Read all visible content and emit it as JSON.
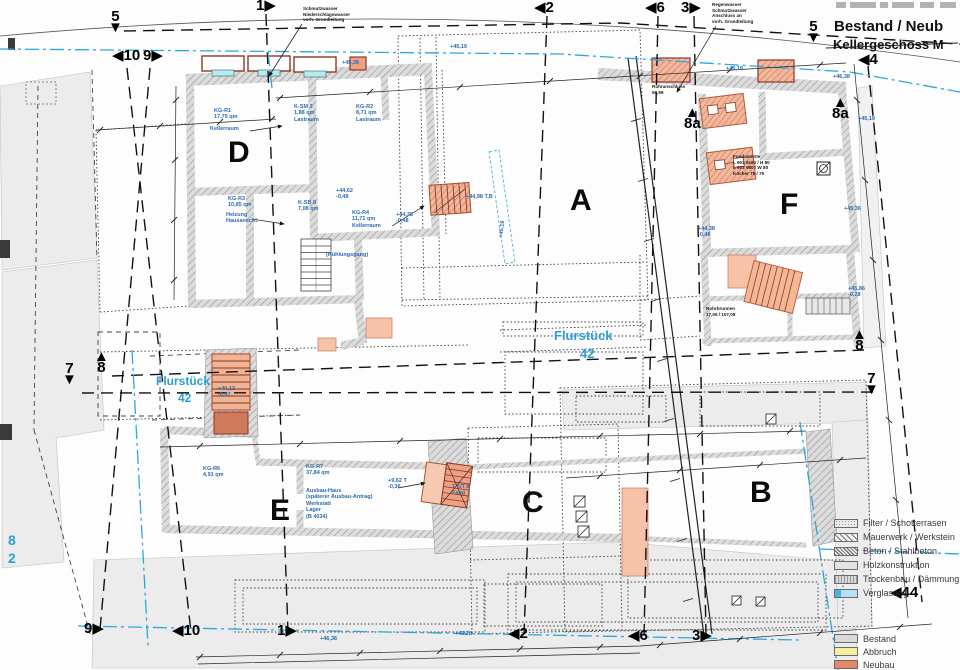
{
  "title": {
    "line1": "Bestand / Neub",
    "line2": "Kellergeschoss M"
  },
  "buildings": [
    {
      "label": "D"
    },
    {
      "label": "A"
    },
    {
      "label": "F"
    },
    {
      "label": "E"
    },
    {
      "label": "C"
    },
    {
      "label": "B"
    }
  ],
  "grid_markers": [
    {
      "n": "5",
      "t": "d",
      "x": 108,
      "y": 12
    },
    {
      "n": "1",
      "t": "r",
      "x": 256,
      "y": 1
    },
    {
      "n": "2",
      "t": "l",
      "x": 534,
      "y": 3
    },
    {
      "n": "6",
      "t": "l",
      "x": 645,
      "y": 3
    },
    {
      "n": "3",
      "t": "r",
      "x": 681,
      "y": 3
    },
    {
      "n": "5",
      "t": "d",
      "x": 806,
      "y": 22
    },
    {
      "n": "10",
      "t": "l",
      "x": 112,
      "y": 51
    },
    {
      "n": "9",
      "t": "r",
      "x": 143,
      "y": 51
    },
    {
      "n": "7",
      "t": "d",
      "x": 62,
      "y": 364
    },
    {
      "n": "8",
      "t": "u",
      "x": 94,
      "y": 352
    },
    {
      "n": "4",
      "t": "l",
      "x": 858,
      "y": 55
    },
    {
      "n": "8a",
      "t": "u",
      "x": 832,
      "y": 98
    },
    {
      "n": "8a",
      "t": "u",
      "x": 684,
      "y": 108
    },
    {
      "n": "8",
      "t": "u",
      "x": 852,
      "y": 330
    },
    {
      "n": "7",
      "t": "d",
      "x": 864,
      "y": 374
    },
    {
      "n": "9",
      "t": "r",
      "x": 84,
      "y": 624
    },
    {
      "n": "10",
      "t": "l",
      "x": 172,
      "y": 626
    },
    {
      "n": "1",
      "t": "r",
      "x": 277,
      "y": 626
    },
    {
      "n": "2",
      "t": "l",
      "x": 508,
      "y": 629
    },
    {
      "n": "6",
      "t": "l",
      "x": 628,
      "y": 631
    },
    {
      "n": "3",
      "t": "r",
      "x": 692,
      "y": 631
    },
    {
      "n": "44",
      "t": "l",
      "x": 890,
      "y": 588
    }
  ],
  "blue_labels": [
    {
      "t": "KG-R1\n17,75 qm",
      "x": 214,
      "y": 108
    },
    {
      "t": "Kellerraum",
      "x": 210,
      "y": 126
    },
    {
      "t": "K-SM 3\n1,88 qm\nLastraum",
      "x": 294,
      "y": 104
    },
    {
      "t": "KG-R2\n8,71 qm\nLastraum",
      "x": 356,
      "y": 104
    },
    {
      "t": "KG-R3\n10,85 qm",
      "x": 228,
      "y": 196
    },
    {
      "t": "Heizung\nHausanschl.",
      "x": 226,
      "y": 212
    },
    {
      "t": "K-SB 8\n7,08 qm",
      "x": 298,
      "y": 200
    },
    {
      "t": "+44,62\n-0,48",
      "x": 336,
      "y": 188
    },
    {
      "t": "KG-R4\n11,71 qm\nKellerraum",
      "x": 352,
      "y": 210
    },
    {
      "t": "(Kühlungsgang)",
      "x": 326,
      "y": 252
    },
    {
      "t": "+44,98 T,B",
      "x": 466,
      "y": 194
    },
    {
      "t": "+44,38\n-0,48",
      "x": 396,
      "y": 212
    },
    {
      "t": "+45,38",
      "x": 342,
      "y": 60
    },
    {
      "t": "+45,19",
      "x": 450,
      "y": 44
    },
    {
      "t": "+45,19",
      "x": 494,
      "y": 226,
      "rot": -83
    },
    {
      "t": "Flurstück",
      "x": 554,
      "y": 328,
      "fs": 13
    },
    {
      "t": "42",
      "x": 580,
      "y": 346,
      "fs": 13
    },
    {
      "t": "Flurstück",
      "x": 156,
      "y": 374,
      "fs": 12
    },
    {
      "t": "42",
      "x": 178,
      "y": 391,
      "fs": 12
    },
    {
      "t": "8",
      "x": 8,
      "y": 532,
      "fs": 14
    },
    {
      "t": "2",
      "x": 8,
      "y": 550,
      "fs": 14
    },
    {
      "t": "KG-R6\n4,91 qm",
      "x": 203,
      "y": 466
    },
    {
      "t": "KG-R7\n37,84 qm",
      "x": 306,
      "y": 464
    },
    {
      "t": "Ausbau-Haus\n(späterer Ausbau-Antrag)\nWerkstatt\nLager\n(B 4034)",
      "x": 306,
      "y": 488
    },
    {
      "t": "+40,12\n-0,57",
      "x": 218,
      "y": 386
    },
    {
      "t": "+9,62 T\n-0,36",
      "x": 388,
      "y": 478
    },
    {
      "t": "T 6/T 8\nFang",
      "x": 452,
      "y": 484
    },
    {
      "t": "+44,38\n-0,48",
      "x": 698,
      "y": 226
    },
    {
      "t": "+45,19",
      "x": 858,
      "y": 116
    },
    {
      "t": "+45,36",
      "x": 844,
      "y": 206
    },
    {
      "t": "+45,86\n-0,28",
      "x": 848,
      "y": 286
    },
    {
      "t": "+46,38",
      "x": 320,
      "y": 636
    },
    {
      "t": "+43,28",
      "x": 455,
      "y": 631
    },
    {
      "t": "+45,19",
      "x": 726,
      "y": 66
    },
    {
      "t": "+46,38",
      "x": 833,
      "y": 74
    }
  ],
  "notes": [
    {
      "t": "Schmutzwasser\nNiederschlagswasser\nvorh. Grundleitung",
      "x": 303,
      "y": 6
    },
    {
      "t": "Regenwasser\nSchmutzwasser\nAnschluss an\nvorh. Grundleitung",
      "x": 712,
      "y": 2
    },
    {
      "t": "Fundamente\nL 903 9160 / H 80\nL 903 980 / W 80\nKöcher 75 / 75",
      "x": 733,
      "y": 154
    },
    {
      "t": "Rohranschluss\n60,98",
      "x": 652,
      "y": 84
    },
    {
      "t": "Rohrbrunnen\n17,05 / 107,08",
      "x": 706,
      "y": 306
    }
  ],
  "legend": {
    "materials": [
      {
        "label": "Filter / Schotterrasen",
        "swatch": "filter"
      },
      {
        "label": "Mauerwerk / Werkstein",
        "swatch": "mauer"
      },
      {
        "label": "Beton / Stahlbeton",
        "swatch": "beton"
      },
      {
        "label": "Holzkonstruktion",
        "swatch": "holz"
      },
      {
        "label": "Trockenbau / Dämmung",
        "swatch": "trocken"
      },
      {
        "label": "Verglasung",
        "swatch": "glas"
      }
    ],
    "status": [
      {
        "label": "Bestand",
        "swatch": "bestand"
      },
      {
        "label": "Abbruch",
        "swatch": "abbruch"
      },
      {
        "label": "Neubau",
        "swatch": "neubau"
      }
    ]
  },
  "colors": {
    "accent_blue": "#29a8e0",
    "label_blue": "#2b6cb0",
    "neubau_orange": "#e8876b",
    "abbruch_yellow": "#f6ef9d",
    "bestand_gray": "#d9d9d9",
    "wall_gray": "#d8d8d8"
  }
}
